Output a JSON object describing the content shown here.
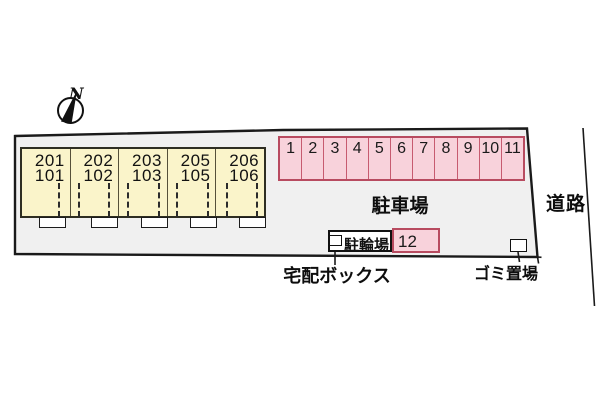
{
  "compass": {
    "label": "N"
  },
  "building": {
    "units": [
      {
        "upper": "201",
        "lower": "101"
      },
      {
        "upper": "202",
        "lower": "102"
      },
      {
        "upper": "203",
        "lower": "103"
      },
      {
        "upper": "205",
        "lower": "105"
      },
      {
        "upper": "206",
        "lower": "106"
      }
    ]
  },
  "parking": {
    "area_label": "駐車場",
    "spaces": [
      "1",
      "2",
      "3",
      "4",
      "5",
      "6",
      "7",
      "8",
      "9",
      "10",
      "11"
    ],
    "space12": "12"
  },
  "facilities": {
    "bicycle": "駐輪場",
    "delivery_box": "宅配ボックス",
    "garbage": "ゴミ置場"
  },
  "road": {
    "label": "道路"
  },
  "colors": {
    "site_fill": "#f0f0f0",
    "site_border": "#1a1a1a",
    "building_fill": "#faf4ca",
    "parking_fill": "#f8d2db",
    "parking_border": "#b84b60"
  }
}
